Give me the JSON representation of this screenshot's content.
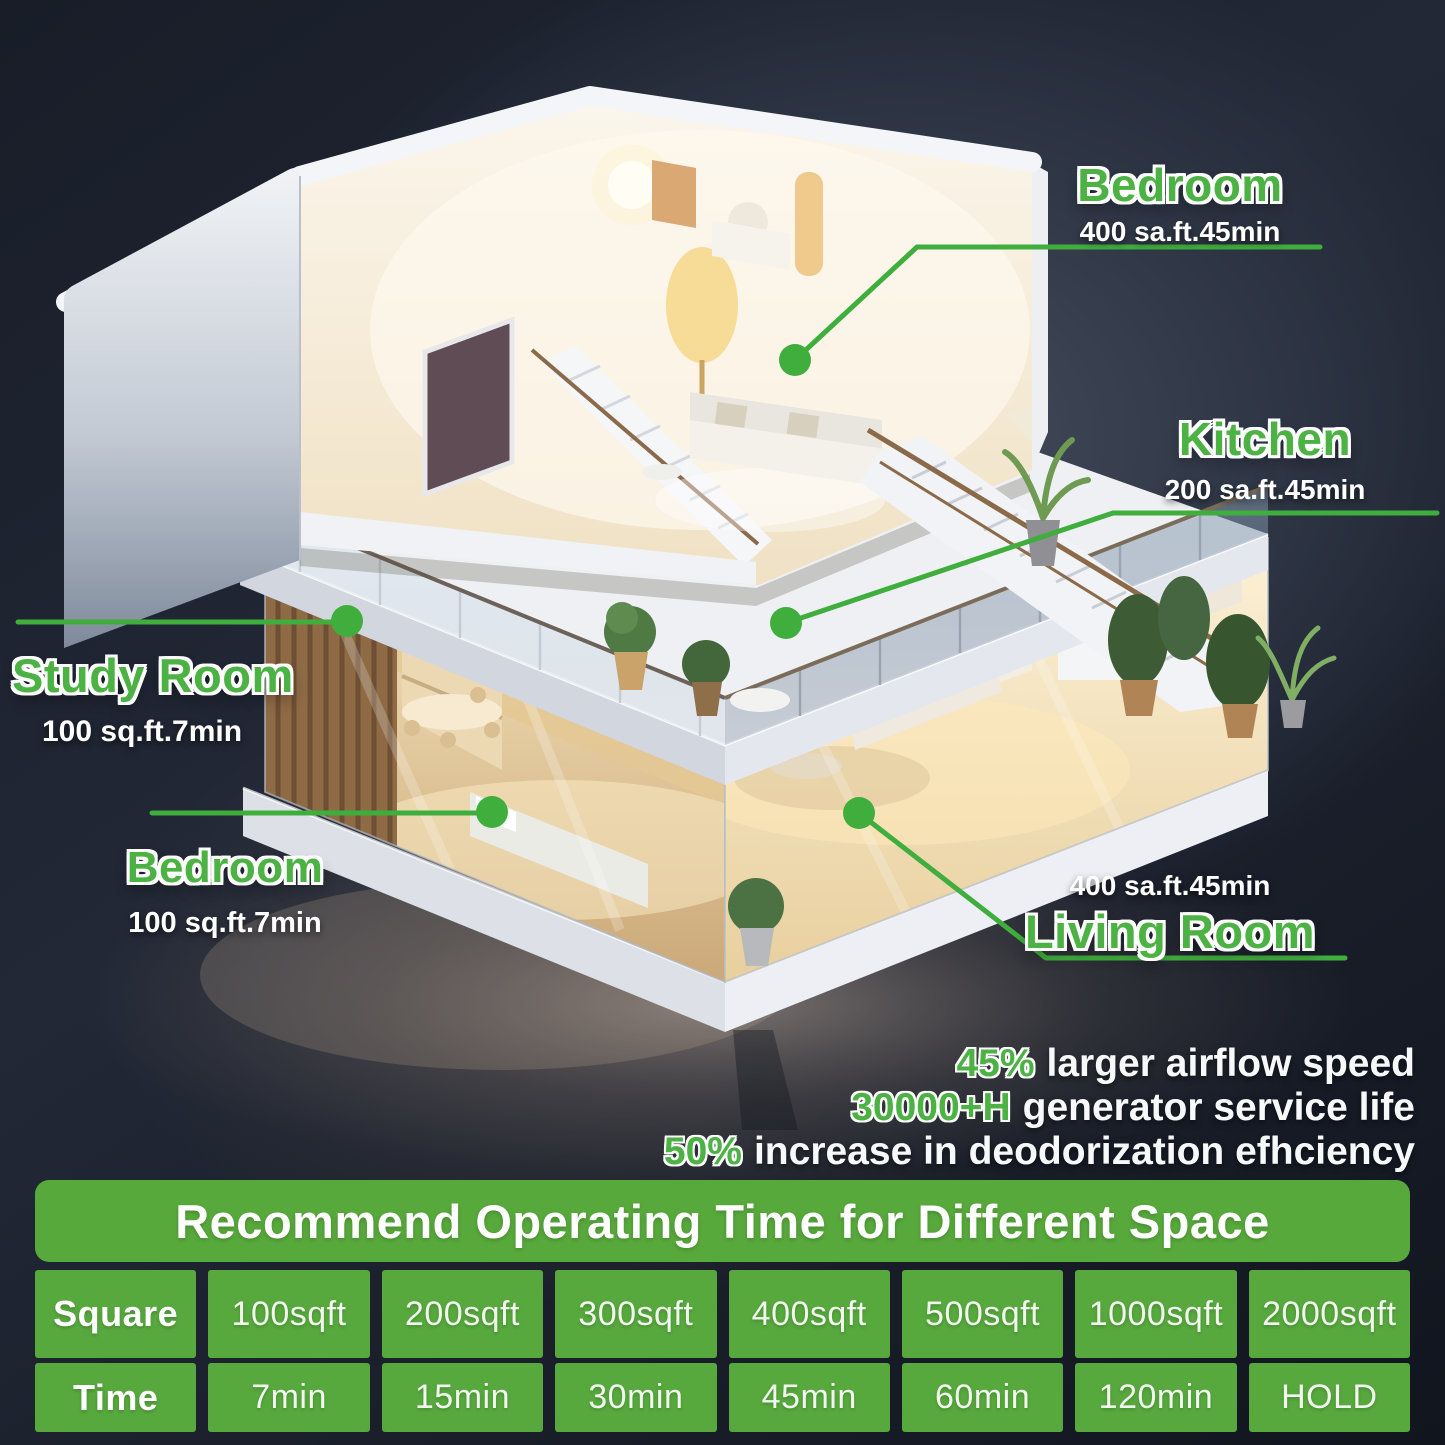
{
  "labels": {
    "bedroom_top": {
      "name": "Bedroom",
      "detail": "400 sa.ft.45min"
    },
    "kitchen": {
      "name": "Kitchen",
      "detail": "200 sa.ft.45min"
    },
    "study_room": {
      "name": "Study Room",
      "detail": "100 sq.ft.7min"
    },
    "bedroom_bottom": {
      "name": "Bedroom",
      "detail": "100 sq.ft.7min"
    },
    "living_room": {
      "name": "Living Room",
      "detail": "400 sa.ft.45min"
    }
  },
  "stats": [
    {
      "value": "45%",
      "text": "larger airflow speed"
    },
    {
      "value": "30000+H",
      "text": "generator service life"
    },
    {
      "value": "50%",
      "text": "increase in deodorization efhciency"
    }
  ],
  "table": {
    "title": "Recommend Operating Time for Different Space",
    "rows": [
      {
        "header": "Square",
        "cells": [
          "100sqft",
          "200sqft",
          "300sqft",
          "400sqft",
          "500sqft",
          "1000sqft",
          "2000sqft"
        ]
      },
      {
        "header": "Time",
        "cells": [
          "7min",
          "15min",
          "30min",
          "45min",
          "60min",
          "120min",
          "HOLD"
        ]
      }
    ]
  },
  "colors": {
    "accent_green": "#4bb243",
    "marker_green": "#3fae3d",
    "banner_green": "#58a93c",
    "table_green": "#57a93e",
    "background_dark": "#1a202c"
  }
}
